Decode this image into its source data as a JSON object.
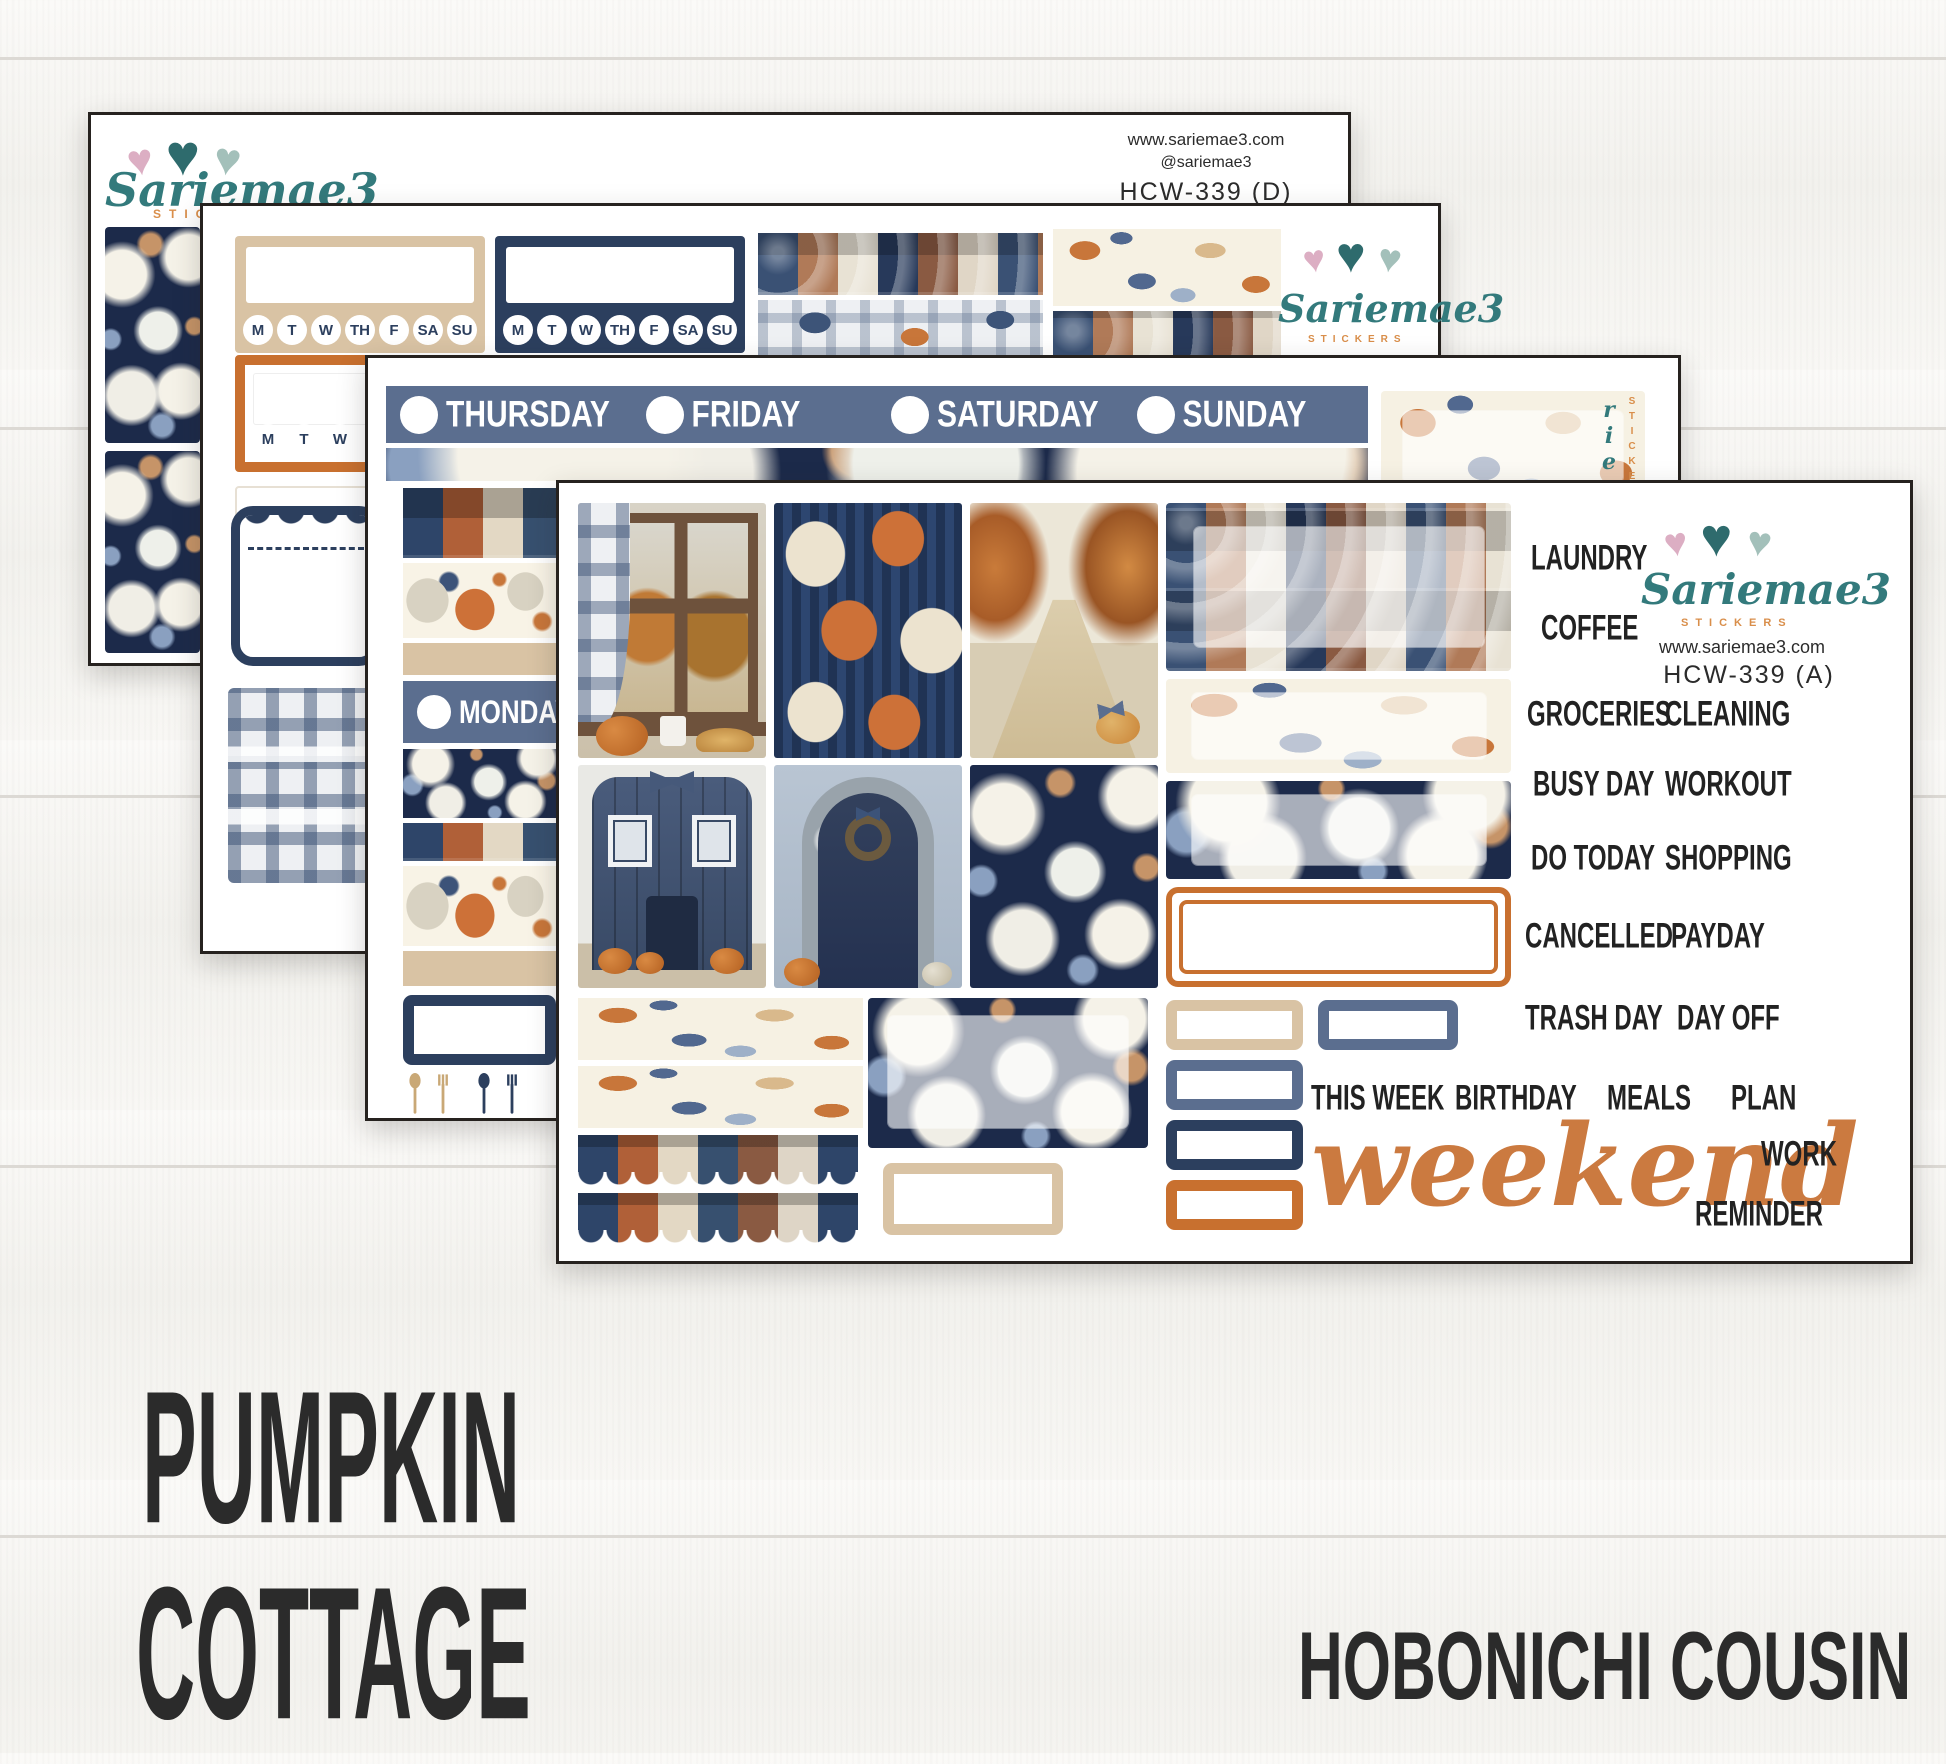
{
  "brand": {
    "name": "Sariemae3",
    "tagline": "STICKERS",
    "website": "www.sariemae3.com",
    "handle": "@sariemae3"
  },
  "sheet_d": {
    "sku": "HCW-339 (D)"
  },
  "sheet_a": {
    "sku": "HCW-339 (A)"
  },
  "tracker_days": [
    "M",
    "T",
    "W",
    "TH",
    "F",
    "SA",
    "SU"
  ],
  "day_strip": [
    "THURSDAY",
    "FRIDAY",
    "SATURDAY",
    "SUNDAY"
  ],
  "monday": "MONDAY",
  "words": {
    "r0": [
      "LAUNDRY"
    ],
    "r1": [
      "COFFEE"
    ],
    "r2": [
      "GROCERIES",
      "CLEANING"
    ],
    "r3": [
      "BUSY DAY",
      "WORKOUT"
    ],
    "r4": [
      "DO TODAY",
      "SHOPPING"
    ],
    "r5": [
      "CANCELLED",
      "PAYDAY"
    ],
    "r6": [
      "TRASH DAY",
      "DAY OFF"
    ],
    "week": [
      "THIS WEEK",
      "BIRTHDAY",
      "MEALS",
      "PLAN"
    ],
    "script": "weekend",
    "work": "WORK",
    "reminder": "REMINDER"
  },
  "title": {
    "line1": "PUMPKIN",
    "line2": "COTTAGE"
  },
  "product_type": "HOBONICHI COUSIN",
  "hearts": [
    "♥",
    "♥",
    "♥"
  ],
  "colors": {
    "navy": "#2c3f5e",
    "slate": "#5b6e8f",
    "orange": "#c8702f",
    "tan": "#d9c3a4",
    "teal": "#337a7c",
    "heart_pink": "#dcaec3",
    "heart_teal": "#2e6b6d",
    "heart_sage": "#a3c0ba",
    "script_orange": "#cb7a40"
  }
}
